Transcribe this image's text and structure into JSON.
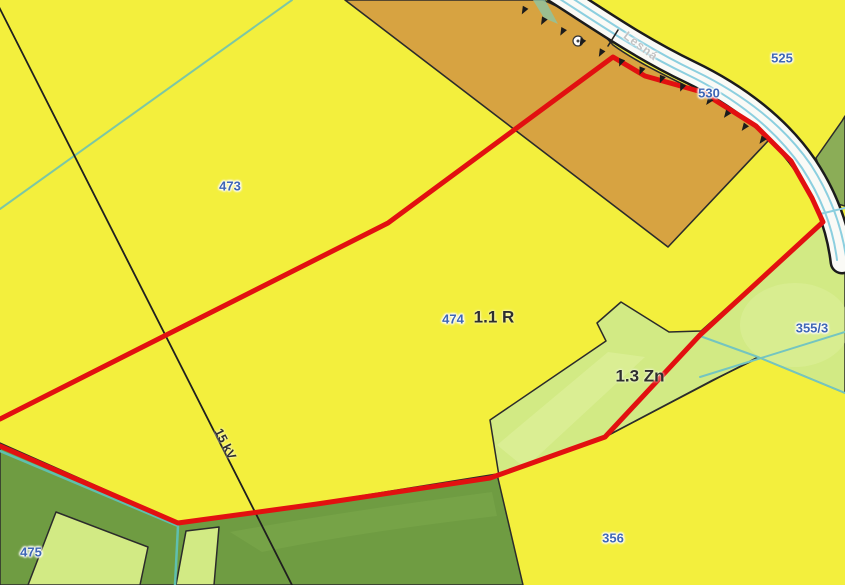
{
  "map": {
    "width": 845,
    "height": 585,
    "colors": {
      "parcel_yellow": "#F3EF3D",
      "parcel_orange": "#D7A341",
      "parcel_dark_green": "#6F9C42",
      "parcel_light_green": "#D2EA84",
      "parcel_medium_green": "#8BAD57",
      "road_fill": "#FAFAF6",
      "road_casing": "#1C1C1C",
      "stream_blue": "#8CCFDF",
      "stream_teal": "#6BC4AE",
      "boundary_black": "#2B2B2B",
      "highlight_red": "#E21010",
      "label_blue": "#3E66B5",
      "label_dark": "#2E2E2E"
    },
    "shapes": [
      {
        "name": "parcel-background-yellow",
        "type": "rect",
        "x": 0,
        "y": 0,
        "w": 845,
        "h": 585,
        "fill": "#F3EF3D",
        "interactable": true
      },
      {
        "name": "parcel-355-3-and-1-3-zn",
        "type": "path",
        "d": "M490,420 L606,341 L597,323 L621,302 L669,332 L701,331 L823,222 L845,252 L845,393 L758,357 L605,437 L499,476 Z",
        "fill": "#D2EA84",
        "stroke": "#2B2B2B",
        "sw": 1.5,
        "interactable": true
      },
      {
        "name": "zone-1-3-zn-highlight",
        "type": "path",
        "d": "M497,445 L608,352 L645,357 L525,468 Z",
        "fill": "#E0F1A0",
        "opacity": 0.55,
        "interactable": false
      },
      {
        "name": "parcel-355-3-highlight",
        "type": "ellipse",
        "cx": 795,
        "cy": 325,
        "rx": 55,
        "ry": 42,
        "fill": "#E0F1A0",
        "opacity": 0.45,
        "interactable": false
      },
      {
        "name": "boundary-356-north",
        "type": "path",
        "d": "M499,476 L605,437 L713,380 L758,358",
        "fill": "none",
        "stroke": "#2B2B2B",
        "sw": 1.6,
        "interactable": false
      },
      {
        "name": "parcel-475-dark-green",
        "type": "path",
        "d": "M0,443 L178,522 L317,503 L497,474 L523,585 L0,585 Z",
        "fill": "#6F9C42",
        "stroke": "#2B2B2B",
        "sw": 1.5,
        "interactable": true
      },
      {
        "name": "parcel-475-shade",
        "type": "path",
        "d": "M230,532 Q340,512 492,492 L497,516 Q360,532 262,552 Z",
        "fill": "#7CA94D",
        "opacity": 0.55,
        "interactable": false
      },
      {
        "name": "parcel-sub-light-green-west",
        "type": "path",
        "d": "M28,585 L56,512 L148,547 L140,585 Z",
        "fill": "#D2EA84",
        "stroke": "#2B2B2B",
        "sw": 1.5,
        "interactable": true
      },
      {
        "name": "parcel-sub-light-green-band",
        "type": "path",
        "d": "M186,531 L219,527 L214,585 L176,585 Z",
        "fill": "#D2EA84",
        "stroke": "#2B2B2B",
        "sw": 1.5,
        "interactable": true
      },
      {
        "name": "parcel-medium-green-east",
        "type": "path",
        "d": "M845,116 L842,121 L816,158 L831,202 L845,206 Z",
        "fill": "#8BAD57",
        "stroke": "#2B2B2B",
        "sw": 1.5,
        "interactable": true
      },
      {
        "name": "parcel-530-orange",
        "type": "path",
        "d": "M345,0 L543,0 C585,18 602,32 613,45 C650,72 702,90 756,124 L768,141 L668,247 Z",
        "fill": "#D7A341",
        "stroke": "#2B2B2B",
        "sw": 1.6,
        "interactable": true
      },
      {
        "name": "stream-bank-sliver",
        "type": "path",
        "d": "M533,0 L545,0 L558,24 L544,18 Z",
        "fill": "#8CC4A4",
        "opacity": 0.8,
        "interactable": false
      },
      {
        "name": "road-casing",
        "type": "path",
        "d": "M556,-8 C600,20 640,48 690,72 C740,96 780,128 806,166 C826,196 838,228 842,262",
        "fill": "none",
        "stroke": "#1C1C1C",
        "sw": 25,
        "interactable": false
      },
      {
        "name": "road-530",
        "type": "path",
        "d": "M556,-8 C600,20 640,48 690,72 C740,96 780,128 806,166 C826,196 838,228 842,262",
        "fill": "none",
        "stroke": "#FAFAF6",
        "sw": 20,
        "interactable": true
      },
      {
        "name": "stream-line-1",
        "type": "path",
        "d": "M552,-6 C596,22 636,50 686,74 C736,98 776,130 802,168 C821,197 833,227 837,260",
        "fill": "none",
        "stroke": "#8CCFDF",
        "sw": 2,
        "interactable": false
      },
      {
        "name": "stream-line-2",
        "type": "path",
        "d": "M561,-9 C605,19 645,47 695,71 C745,95 785,127 811,165 C831,196 843,230 847,264",
        "fill": "none",
        "stroke": "#8CCFDF",
        "sw": 2,
        "interactable": false
      },
      {
        "name": "stream-branch-east",
        "type": "path",
        "d": "M820,214 L845,208",
        "fill": "none",
        "stroke": "#8CCFDF",
        "sw": 2,
        "interactable": false
      },
      {
        "name": "stream-teal-northwest",
        "type": "path",
        "d": "M0,209 L292,0",
        "fill": "none",
        "stroke": "#7CC7A4",
        "sw": 2,
        "interactable": false
      },
      {
        "name": "stream-teal-southwest",
        "type": "path",
        "d": "M0,451 L178,526 L175,585",
        "fill": "none",
        "stroke": "#5FBFAE",
        "sw": 2.5,
        "interactable": false
      },
      {
        "name": "stream-east-a",
        "type": "path",
        "d": "M700,336 L758,357 L845,393",
        "fill": "none",
        "stroke": "#74C5C0",
        "sw": 2,
        "interactable": false
      },
      {
        "name": "stream-east-b",
        "type": "path",
        "d": "M700,377 L845,332",
        "fill": "none",
        "stroke": "#74C5C0",
        "sw": 2,
        "interactable": false
      },
      {
        "name": "power-line-15kv",
        "type": "path",
        "d": "M-2,5 L292,585",
        "fill": "none",
        "stroke": "#1F1F1F",
        "sw": 1.8,
        "interactable": false
      },
      {
        "name": "road-crossing-tick",
        "type": "path",
        "d": "M608,46 L618,30",
        "fill": "none",
        "stroke": "#222222",
        "sw": 1.6,
        "interactable": false
      },
      {
        "name": "selection-boundary-red",
        "type": "path",
        "d": "M0,419 L388,223 L613,57 L645,76 L702,92 L756,126 L791,161 L812,198 L823,222 L700,335 L605,437 L490,478 L317,504 L178,523 L0,446",
        "fill": "none",
        "stroke": "#E21010",
        "sw": 5,
        "interactable": false
      },
      {
        "name": "culvert-symbol",
        "type": "circle",
        "cx": 578,
        "cy": 41,
        "r": 5,
        "fill": "#FFFFFF",
        "stroke": "#333333",
        "sw": 1.2,
        "interactable": false
      },
      {
        "name": "culvert-symbol-dot",
        "type": "circle",
        "cx": 578,
        "cy": 41,
        "r": 1.5,
        "fill": "#444444",
        "interactable": false
      }
    ],
    "hatch": {
      "name": "embankment-hatch",
      "points": [
        [
          516,
          2
        ],
        [
          612,
          55
        ],
        [
          702,
          92
        ],
        [
          765,
          138
        ]
      ],
      "spacing": 22,
      "size": 8,
      "half_base": 3.2,
      "color": "#1C1C1C"
    },
    "labels": [
      {
        "name": "parcel-label-473",
        "text": "473",
        "x": 230,
        "y": 186,
        "cls": "lbl-blue"
      },
      {
        "name": "parcel-label-474",
        "text": "474",
        "x": 453,
        "y": 319,
        "cls": "lbl-blue"
      },
      {
        "name": "parcel-label-525",
        "text": "525",
        "x": 782,
        "y": 58,
        "cls": "lbl-blue"
      },
      {
        "name": "parcel-label-530",
        "text": "530",
        "x": 709,
        "y": 93,
        "cls": "lbl-blue"
      },
      {
        "name": "parcel-label-355-3",
        "text": "355/3",
        "x": 812,
        "y": 328,
        "cls": "lbl-blue"
      },
      {
        "name": "parcel-label-356",
        "text": "356",
        "x": 613,
        "y": 538,
        "cls": "lbl-blue"
      },
      {
        "name": "parcel-label-475",
        "text": "475",
        "x": 31,
        "y": 552,
        "cls": "lbl-blue"
      },
      {
        "name": "zone-label-1-1-r",
        "text": "1.1 R",
        "x": 494,
        "y": 317,
        "cls": "lbl-dark",
        "rotate": 0
      },
      {
        "name": "zone-label-1-3-zn",
        "text": "1.3 Zn",
        "x": 640,
        "y": 376,
        "cls": "lbl-dark",
        "rotate": 0
      },
      {
        "name": "utility-label-15kv",
        "text": "15 kV",
        "x": 225,
        "y": 444,
        "cls": "lbl-dark",
        "size": 12.5,
        "rotate": 63
      },
      {
        "name": "street-label-lesna",
        "text": "Lesná",
        "x": 641,
        "y": 46,
        "cls": "lbl-street",
        "rotate": 37
      }
    ]
  }
}
